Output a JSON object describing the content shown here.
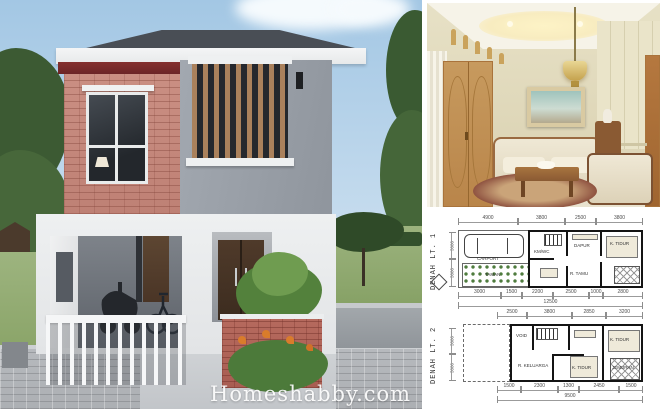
{
  "watermark": {
    "text": "Homeshabby.com"
  },
  "colors": {
    "sky": "#a3c7e4",
    "brick": "#c48a7e",
    "roof": "#474c53",
    "fascia": "#f1f2f3",
    "accent_red_band": "#7d2c2f",
    "stucco_gray": "#9aa1a9",
    "wood_slat": "#aa815c",
    "entry_door": "#4a3628",
    "lawn": "#8fa870",
    "pavement": "#b4b7bb",
    "interior_wall": "#e3dcc0",
    "interior_door": "#c3944f",
    "plan_line": "#141414"
  },
  "exterior": {
    "description": "two-story minimalist house render, brick and gray stucco facade",
    "elements": [
      "roof",
      "fascia",
      "brick wall with window",
      "wood slat screen window",
      "carport with motorcycle and bicycle",
      "white picket gate",
      "brick planter with plants",
      "entry double door",
      "lawn",
      "trees",
      "paved street"
    ]
  },
  "interior": {
    "description": "cream living room with wooden doors, pendant brass lamp, seascape painting, cream sofa set, coffee table and rug"
  },
  "plans": [
    {
      "label": "DENAH LT. 1",
      "top_dims": [
        "4900",
        "3800",
        "2500",
        "3800"
      ],
      "bottom_dims": [
        "3000",
        "1500",
        "2200",
        "2500",
        "1000",
        "2800"
      ],
      "bottom_total": "12500",
      "left_dims": [
        "3000",
        "3000"
      ],
      "rooms": {
        "carport": "CARPORT",
        "garden": "TAMAN",
        "living": "R. TAMU",
        "kitchen": "DAPUR",
        "bath": "KM/WC",
        "bedroom": "K. TIDUR"
      }
    },
    {
      "label": "DENAH LT. 2",
      "top_dims": [
        "2500",
        "3800",
        "2850",
        "3200"
      ],
      "bottom_dims": [
        "1500",
        "2300",
        "1300",
        "2450",
        "1500"
      ],
      "bottom_total": "9500",
      "left_dims": [
        "3000",
        "3000"
      ],
      "rooms": {
        "void": "VOID",
        "family": "R. KELUARGA",
        "bedroom1": "K. TIDUR",
        "bedroom2": "K. TIDUR",
        "laundry": "JEMURAN"
      }
    }
  ]
}
